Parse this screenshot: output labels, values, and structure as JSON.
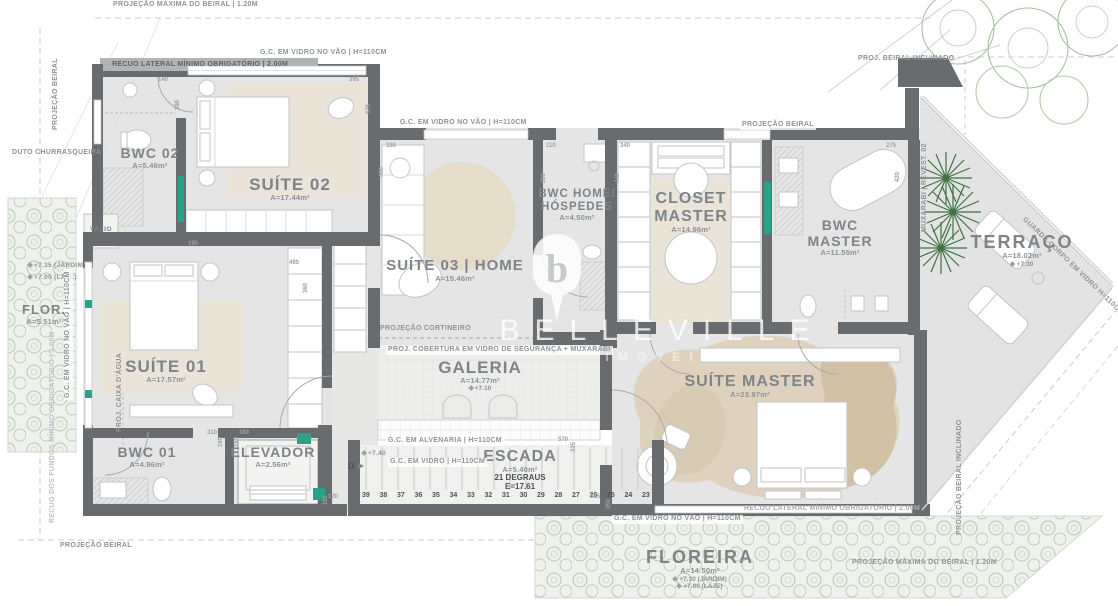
{
  "watermark": {
    "brand": "BELLEVILLE",
    "sub": "IMÓVEIS",
    "pin_letter": "b"
  },
  "rooms": {
    "bwc02": {
      "name": "BWC 02",
      "area": "A=5.46m²"
    },
    "suite02": {
      "name": "SUÍTE 02",
      "area": "A=17.44m²"
    },
    "suite03": {
      "name": "SUÍTE 03 | HOME",
      "area": "A=15.46m²"
    },
    "bwc_home": {
      "name": "BWC HOME/",
      "name2": "HÓSPEDES",
      "area": "A=4.50m²"
    },
    "closet_master": {
      "name": "CLOSET",
      "name2": "MASTER",
      "area": "A=14.96m²"
    },
    "bwc_master": {
      "name": "BWC",
      "name2": "MASTER",
      "area": "A=11.55m²"
    },
    "terraco": {
      "name": "TERRAÇO",
      "area": "A=18.02m²",
      "level": "+7.30"
    },
    "suite_master": {
      "name": "SUÍTE MASTER",
      "area": "A=23.97m²"
    },
    "suite01": {
      "name": "SUÍTE 01",
      "area": "A=17.57m²"
    },
    "bwc01": {
      "name": "BWC 01",
      "area": "A=4.96m²"
    },
    "elevador": {
      "name": "ELEVADOR",
      "area": "A=2.56m²"
    },
    "galeria": {
      "name": "GALERIA",
      "area": "A=14.77m²",
      "level": "+7.10"
    },
    "escada": {
      "name": "ESCADA",
      "area": "A=5.40m²",
      "steps": "21 DEGRAUS",
      "e": "E=17.61"
    },
    "floreira": {
      "name": "FLOREIRA",
      "area": "A=14.50m²",
      "level1": "+7.30 (JARDIM)",
      "level2": "+7.00 (LAJE)"
    },
    "flor_left": {
      "name": "FLOR.",
      "area": "A=5.51m²"
    },
    "vazio": {
      "name": "VAZIO"
    }
  },
  "marker_d": {
    "label": "D",
    "level": "+7.40"
  },
  "stairs": [
    "39",
    "38",
    "37",
    "36",
    "35",
    "34",
    "33",
    "32",
    "31",
    "30",
    "29",
    "28",
    "27",
    "26",
    "25",
    "24",
    "23"
  ],
  "notes": [
    {
      "t": "PROJEÇÃO MÁXIMA DO BEIRAL | 1.20M",
      "x": 113,
      "y": 1,
      "c": "bare"
    },
    {
      "t": "PROJEÇÃO BEIRAL",
      "x": 52,
      "y": 130,
      "r": -90,
      "c": "bare"
    },
    {
      "t": "G.C. EM VIDRO NO VÃO | H=110CM",
      "x": 258,
      "y": 49
    },
    {
      "t": "RECUO LATERAL MÍNIMO OBRIGATÓRIO | 2.00M",
      "x": 110,
      "y": 61,
      "c": "on-band"
    },
    {
      "t": "G.C. EM VIDRO NO VÃO | H=110CM",
      "x": 398,
      "y": 119
    },
    {
      "t": "PROJEÇÃO BEIRAL",
      "x": 740,
      "y": 121
    },
    {
      "t": "PROJ. BEIRAL INCLINADO",
      "x": 858,
      "y": 55,
      "c": "bare"
    },
    {
      "t": "DUTO CHURRASQUEIRA",
      "x": 12,
      "y": 149,
      "c": "bare"
    },
    {
      "t": "+7.35 (JARDIM)",
      "x": 28,
      "y": 262,
      "c": "lvl"
    },
    {
      "t": "+7.05 (LAJE)",
      "x": 28,
      "y": 274,
      "c": "lvl"
    },
    {
      "t": "G.C. EM VIDRO NO VÃO | H=110CM",
      "x": 64,
      "y": 400,
      "r": -90
    },
    {
      "t": "RECUO DOS FUNDOS MÍNIMO OBRIGATÓRIO | 3.00M",
      "x": 49,
      "y": 525,
      "r": -90,
      "c": "faint"
    },
    {
      "t": "PROJ. CAIXA D'ÁGUA",
      "x": 116,
      "y": 432,
      "r": -90,
      "c": "bare"
    },
    {
      "t": "PROJEÇÃO CORTINEIRO",
      "x": 380,
      "y": 325,
      "c": "bare"
    },
    {
      "t": "PROJ. COBERTURA EM VIDRO DE SEGURANÇA + MUXARABI",
      "x": 386,
      "y": 346
    },
    {
      "t": "G.C. EM ALVENARIA | H=110CM",
      "x": 386,
      "y": 437
    },
    {
      "t": "G.C. EM VIDRO | H=110CM",
      "x": 388,
      "y": 458
    },
    {
      "t": "MUXARABI | REVEST. 02",
      "x": 921,
      "y": 232,
      "r": -90,
      "c": "bare"
    },
    {
      "t": "GUARDA-CORPO EM VIDRO H=110CM",
      "x": 1026,
      "y": 216,
      "r": 44,
      "c": "bare"
    },
    {
      "t": "G.C. EM VIDRO NO VÃO | H=110CM",
      "x": 612,
      "y": 515
    },
    {
      "t": "RECUO LATERAL MÍNIMO OBRIGATÓRIO | 2.00M",
      "x": 742,
      "y": 505,
      "c": "on-wall"
    },
    {
      "t": "PROJEÇÃO MÁXIMA DO BEIRAL | 1.20M",
      "x": 852,
      "y": 559,
      "c": "bare"
    },
    {
      "t": "PROJEÇÃO BEIRAL",
      "x": 60,
      "y": 542,
      "c": "bare"
    },
    {
      "t": "PROJEÇÃO BEIRAL INCLINADO",
      "x": 956,
      "y": 535,
      "r": -90,
      "c": "bare"
    }
  ],
  "dims": [
    {
      "t": "140",
      "x": 158,
      "y": 77
    },
    {
      "t": "390",
      "x": 175,
      "y": 110,
      "r": -90
    },
    {
      "t": "395",
      "x": 349,
      "y": 77
    },
    {
      "t": "575",
      "x": 366,
      "y": 114,
      "r": -90
    },
    {
      "t": "295",
      "x": 188,
      "y": 241
    },
    {
      "t": "495",
      "x": 289,
      "y": 260
    },
    {
      "t": "360",
      "x": 303,
      "y": 293,
      "r": -90
    },
    {
      "t": "330",
      "x": 386,
      "y": 143
    },
    {
      "t": "400",
      "x": 379,
      "y": 177,
      "r": -90
    },
    {
      "t": "110",
      "x": 546,
      "y": 143
    },
    {
      "t": "390",
      "x": 541,
      "y": 183,
      "r": -90
    },
    {
      "t": "340",
      "x": 620,
      "y": 143
    },
    {
      "t": "440",
      "x": 615,
      "y": 183,
      "r": -90
    },
    {
      "t": "275",
      "x": 886,
      "y": 143
    },
    {
      "t": "420",
      "x": 895,
      "y": 182,
      "r": -90
    },
    {
      "t": "310",
      "x": 207,
      "y": 430
    },
    {
      "t": "160",
      "x": 218,
      "y": 447,
      "r": -90
    },
    {
      "t": "160",
      "x": 239,
      "y": 430
    },
    {
      "t": "160",
      "x": 234,
      "y": 447,
      "r": -90
    },
    {
      "t": "115",
      "x": 323,
      "y": 505,
      "r": -90
    },
    {
      "t": "120",
      "x": 328,
      "y": 494
    },
    {
      "t": "570",
      "x": 558,
      "y": 437
    },
    {
      "t": "335",
      "x": 571,
      "y": 452,
      "r": -90
    },
    {
      "t": "685",
      "x": 590,
      "y": 494
    },
    {
      "t": "350",
      "x": 606,
      "y": 509,
      "r": -90
    }
  ],
  "colors": {
    "wall": "#686c6f",
    "teal": "#2ba189",
    "floor": "#e5e5e5",
    "carpet": "#eae3d8",
    "rug": "#ddd1bc",
    "green_light": "#b3c8ab",
    "green_palm": "#3f7340",
    "label": "#7e8487",
    "note": "#8f9396",
    "accent_dark": "#4e5254"
  }
}
